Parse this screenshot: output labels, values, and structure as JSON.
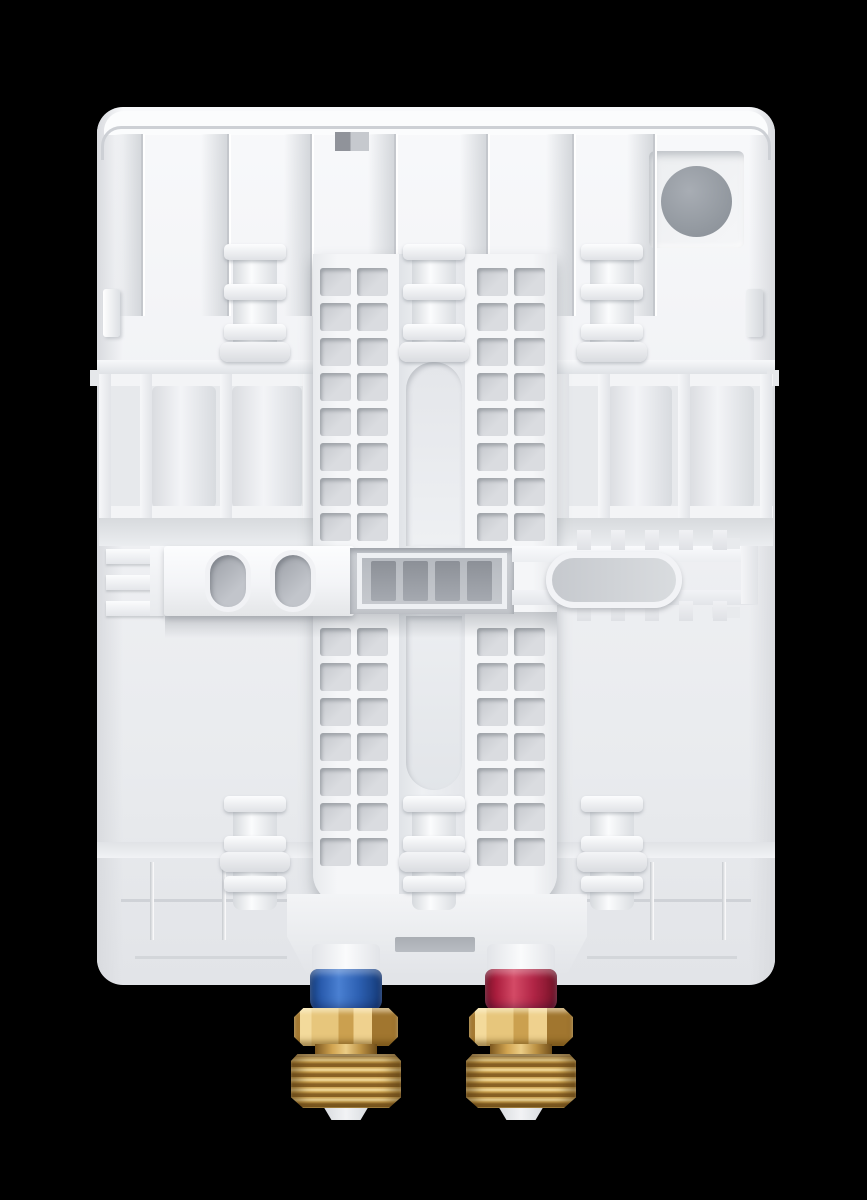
{
  "meta": {
    "description": "Product photo: rear mounting panel of a white tankless electric water heater on black background, with cold (blue) and hot (red) brass water connections at the bottom",
    "background_color": "#000000"
  },
  "device": {
    "type": "tankless-water-heater-back-panel",
    "body_color": "#f1f2f5",
    "recess_color": "#c9ccd1",
    "slot_color": "#a9adb3",
    "knockout_color": "#949aa1"
  },
  "connections": {
    "cold_inlet": {
      "name": "cold-water-inlet",
      "collar_color": "#2a5cae",
      "collar_gradient": "linear-gradient(90deg,#16407f 0%,#2a5cae 16%,#4a80d2 40%,#2d60b2 68%,#143a78 100%)"
    },
    "hot_outlet": {
      "name": "hot-water-outlet",
      "collar_color": "#ab1e3e",
      "collar_gradient": "linear-gradient(90deg,#7e142a 0%,#ab1e3e 16%,#d44a66 40%,#b02445 68%,#731226 100%)"
    },
    "brass_light": "#f3da9b",
    "brass_mid": "#cba04f",
    "brass_dark": "#8a6225"
  },
  "geometry": {
    "body": {
      "x": 97,
      "y": 107,
      "w": 678,
      "h": 878,
      "r": 26
    },
    "ribs": {
      "xs": [
        141,
        227,
        310,
        394,
        486,
        572,
        653
      ],
      "y": 134,
      "w": 4,
      "h": 182
    },
    "ladder": {
      "cols": [
        320,
        357,
        477,
        514
      ],
      "hole_w": 31,
      "hole_h": 28,
      "upper_rows": [
        268,
        303,
        338,
        373,
        408,
        443,
        478,
        513
      ],
      "lower_rows": [
        628,
        663,
        698,
        733,
        768,
        803,
        838
      ],
      "hole_fill": "linear-gradient(135deg,#c3c6cb,#dadce0 60%)",
      "hole_shadow": "inset 2px 3px 3px rgba(120,125,132,.5)"
    },
    "bosses": {
      "centers": [
        255,
        434,
        612
      ],
      "top_y": 244,
      "bottom_y": 796,
      "cyl_fill": "linear-gradient(90deg,#d6d9dd,#fbfcfd 42%,#dadde1)",
      "ring_fill": "linear-gradient(180deg,#fcfdfe,#e0e2e6)",
      "disc_fill": "linear-gradient(180deg,#f4f5f7,#dadce0)",
      "ring_shadow": "0 2px 3px rgba(140,146,153,.5)"
    },
    "teeth": {
      "xs": [
        577,
        611,
        645,
        679,
        713
      ],
      "y_top": 530,
      "y_bottom": 601,
      "w": 14,
      "h": 20,
      "fill": "linear-gradient(180deg,#f0f1f4,#dfe1e5)"
    },
    "fittings": [
      {
        "name": "cold-inlet",
        "cx": 346,
        "collar": "cold_inlet"
      },
      {
        "name": "hot-outlet",
        "cx": 521,
        "collar": "hot_outlet"
      }
    ],
    "fitting_style": {
      "stub_fill": "linear-gradient(90deg,#e2e4e8,#fafbfc 50%,#e2e4e8)",
      "hex_fill": "linear-gradient(90deg,#a87c33 0 6%,#f3da9b 6% 17%,#e7c67c 17% 43%,#cba04f 43% 57%,#efd18e 57% 75%,#a1762f 75% 100%)",
      "hex_clip": "polygon(9% 0,91% 0,100% 24%,100% 76%,91% 100%,9% 100%,0 76%,0 24%)",
      "hex_shadow": "inset 0 4px 4px rgba(255,248,220,.55), inset 0 -5px 6px rgba(90,60,10,.5)",
      "washer_fill": "linear-gradient(90deg,#7c571f,#d2a551 28%,#eccd86 50%,#bd9244 74%,#6f4d19)",
      "threads_fill": "repeating-linear-gradient(180deg,#8a6225 0px,#8a6225 3px,#caa04e 3px,#f4dda0 6px,#caa04e 8px,#8a6225 10px)",
      "threads_clip": "polygon(6% 0,94% 0,100% 13%,100% 80%,89% 100%,11% 100%,0 80%,0 13%)",
      "threads_shadow": "inset 10px 0 12px rgba(90,62,20,.55), inset -10px 0 12px rgba(90,62,20,.55), inset 0 3px 2px rgba(255,240,200,.6)",
      "tip_fill": "linear-gradient(90deg,#d4d7db,#f2f3f5 50%,#d4d7db)",
      "tip_clip": "polygon(6% 0,94% 0,78% 100%,22% 100%)",
      "collar_shadow": "inset 0 5px 6px rgba(255,255,255,.3), inset 0 -6px 9px rgba(10,10,40,.35)"
    },
    "parts": [
      {
        "n": "heater-body",
        "x": 97,
        "y": 107,
        "w": 678,
        "h": 878,
        "r": "26px",
        "f": "linear-gradient(180deg,#f8f9fb,#f1f2f5 35%,#e9ebee 75%,#e2e4e8 100%)",
        "z": 1
      },
      {
        "n": "body-left-shade",
        "x": 97,
        "y": 107,
        "w": 26,
        "h": 878,
        "r": "26px 0 0 26px",
        "f": "linear-gradient(90deg,#d9dbdf,rgba(217,219,223,0))",
        "z": 2
      },
      {
        "n": "body-right-shade",
        "x": 749,
        "y": 107,
        "w": 26,
        "h": 878,
        "r": "0 26px 26px 0",
        "f": "linear-gradient(270deg,#d9dbdf,rgba(217,219,223,0))",
        "z": 2
      },
      {
        "n": "top-cover-strip",
        "x": 104,
        "y": 111,
        "w": 664,
        "h": 24,
        "r": "20px 20px 0 0",
        "f": "#fbfcfd",
        "z": 2
      },
      {
        "n": "top-edge-line",
        "x": 101,
        "y": 126,
        "w": 670,
        "h": 34,
        "r": "20px 20px 0 0",
        "br": "3px solid #cdd0d5",
        "f": "transparent",
        "z": 3
      },
      {
        "n": "top-notch",
        "x": 335,
        "y": 132,
        "w": 34,
        "h": 19,
        "f": "linear-gradient(90deg,#90939a 0 45%,#c6c9ce 45%)",
        "z": 4
      },
      {
        "n": "cable-knockout-recess",
        "x": 649,
        "y": 151,
        "w": 95,
        "h": 97,
        "r": "6px",
        "f": "linear-gradient(135deg,#eceef0,#f5f6f8)",
        "s": "inset 3px 4px 8px rgba(140,146,153,.5), inset -2px -3px 5px rgba(255,255,255,.9)",
        "z": 4
      },
      {
        "n": "cable-knockout-circle",
        "x": 661,
        "y": 166,
        "w": 71,
        "h": 71,
        "r": "50%",
        "f": "radial-gradient(circle at 40% 35%, #a8adb4 0%, #949aa1 60%, #878d95 100%)",
        "z": 5
      },
      {
        "n": "side-tab-left",
        "x": 103,
        "y": 289,
        "w": 17,
        "h": 48,
        "r": "3px",
        "f": "linear-gradient(90deg,#ffffff,#dde0e4)",
        "s": "2px 2px 3px rgba(150,155,162,.4)",
        "z": 4
      },
      {
        "n": "side-tab-right",
        "x": 746,
        "y": 289,
        "w": 17,
        "h": 48,
        "r": "3px",
        "f": "linear-gradient(90deg,#eef0f2,#d6d9dd)",
        "s": "2px 2px 3px rgba(150,155,162,.4)",
        "z": 4
      },
      {
        "n": "side-stub-left",
        "x": 90,
        "y": 370,
        "w": 10,
        "h": 16,
        "f": "#e6e8eb",
        "z": 4
      },
      {
        "n": "side-stub-right",
        "x": 767,
        "y": 370,
        "w": 12,
        "h": 16,
        "f": "#e6e8eb",
        "z": 4
      },
      {
        "n": "ledge-left",
        "x": 97,
        "y": 360,
        "w": 218,
        "h": 14,
        "f": "linear-gradient(180deg,#f7f8fa,#dfe2e6)",
        "z": 3
      },
      {
        "n": "ledge-right",
        "x": 555,
        "y": 360,
        "w": 220,
        "h": 14,
        "f": "linear-gradient(180deg,#f7f8fa,#dfe2e6)",
        "z": 3
      },
      {
        "n": "left-frame-recess",
        "x": 99,
        "y": 374,
        "w": 216,
        "h": 146,
        "f": "#e7e9ec",
        "s": "inset 2px 3px 6px rgba(150,156,163,.45)",
        "z": 3
      },
      {
        "n": "left-frame-cylinder-1",
        "x": 152,
        "y": 386,
        "w": 64,
        "h": 122,
        "r": "6px",
        "f": "linear-gradient(90deg,#dadce0,#f3f4f7 45%,#d8dbdf)",
        "z": 3
      },
      {
        "n": "left-frame-cylinder-2",
        "x": 232,
        "y": 386,
        "w": 70,
        "h": 122,
        "r": "6px",
        "f": "linear-gradient(90deg,#dadce0,#f3f4f7 45%,#d8dbdf)",
        "z": 3
      },
      {
        "n": "left-frame-rail-top",
        "x": 99,
        "y": 374,
        "w": 216,
        "h": 12,
        "f": "#f3f4f6",
        "z": 4
      },
      {
        "n": "left-frame-rail-bottom",
        "x": 99,
        "y": 506,
        "w": 216,
        "h": 12,
        "f": "#f3f4f6",
        "z": 4
      },
      {
        "n": "left-frame-rail-v1",
        "x": 99,
        "y": 374,
        "w": 12,
        "h": 144,
        "f": "linear-gradient(90deg,#f6f7f9,#e2e4e8)",
        "z": 4
      },
      {
        "n": "left-frame-rail-v2",
        "x": 140,
        "y": 374,
        "w": 12,
        "h": 144,
        "f": "linear-gradient(90deg,#f6f7f9,#e2e4e8)",
        "z": 4
      },
      {
        "n": "left-frame-rail-v3",
        "x": 220,
        "y": 374,
        "w": 12,
        "h": 144,
        "f": "linear-gradient(90deg,#f6f7f9,#e2e4e8)",
        "z": 4
      },
      {
        "n": "left-frame-rail-v4",
        "x": 303,
        "y": 374,
        "w": 12,
        "h": 144,
        "f": "linear-gradient(90deg,#f6f7f9,#e2e4e8)",
        "z": 4
      },
      {
        "n": "right-frame-recess",
        "x": 557,
        "y": 374,
        "w": 216,
        "h": 146,
        "f": "#e7e9ec",
        "s": "inset 2px 3px 6px rgba(150,156,163,.45)",
        "z": 3
      },
      {
        "n": "right-frame-cylinder-1",
        "x": 608,
        "y": 386,
        "w": 64,
        "h": 122,
        "r": "6px",
        "f": "linear-gradient(90deg,#dadce0,#f3f4f7 45%,#d8dbdf)",
        "z": 3
      },
      {
        "n": "right-frame-cylinder-2",
        "x": 688,
        "y": 386,
        "w": 66,
        "h": 122,
        "r": "6px",
        "f": "linear-gradient(90deg,#dadce0,#f3f4f7 45%,#d8dbdf)",
        "z": 3
      },
      {
        "n": "right-frame-rail-top",
        "x": 557,
        "y": 374,
        "w": 216,
        "h": 12,
        "f": "#f3f4f6",
        "z": 4
      },
      {
        "n": "right-frame-rail-bottom",
        "x": 557,
        "y": 506,
        "w": 216,
        "h": 12,
        "f": "#f3f4f6",
        "z": 4
      },
      {
        "n": "right-frame-rail-v1",
        "x": 557,
        "y": 374,
        "w": 12,
        "h": 144,
        "f": "linear-gradient(90deg,#f6f7f9,#e2e4e8)",
        "z": 4
      },
      {
        "n": "right-frame-rail-v2",
        "x": 598,
        "y": 374,
        "w": 12,
        "h": 144,
        "f": "linear-gradient(90deg,#f6f7f9,#e2e4e8)",
        "z": 4
      },
      {
        "n": "right-frame-rail-v3",
        "x": 678,
        "y": 374,
        "w": 12,
        "h": 144,
        "f": "linear-gradient(90deg,#f6f7f9,#e2e4e8)",
        "z": 4
      },
      {
        "n": "right-frame-rail-v4",
        "x": 760,
        "y": 374,
        "w": 12,
        "h": 144,
        "f": "linear-gradient(90deg,#f6f7f9,#e2e4e8)",
        "z": 4
      },
      {
        "n": "mid-lower-shade-left",
        "x": 99,
        "y": 518,
        "w": 216,
        "h": 28,
        "f": "linear-gradient(180deg,#d7dadd,#ebedf0)",
        "z": 3
      },
      {
        "n": "mid-lower-shade-right",
        "x": 557,
        "y": 518,
        "w": 216,
        "h": 28,
        "f": "linear-gradient(180deg,#d7dadd,#ebedf0)",
        "z": 3
      },
      {
        "n": "ladder-slab",
        "x": 313,
        "y": 254,
        "w": 244,
        "h": 650,
        "r": "0 0 30px 30px",
        "f": "linear-gradient(90deg,#e8eaed,#f5f6f8 10%,#f5f6f8 90%,#e6e8eb)",
        "s": "0 8px 14px rgba(120,126,133,.45)",
        "z": 5
      },
      {
        "n": "ladder-center-channel",
        "x": 399,
        "y": 254,
        "w": 66,
        "h": 650,
        "f": "linear-gradient(90deg,#e0e3e7,#eef0f3 35%,#e4e6ea)",
        "z": 6
      },
      {
        "n": "center-slot-upper",
        "x": 406,
        "y": 362,
        "w": 56,
        "h": 184,
        "r": "28px 28px 0 0",
        "f": "linear-gradient(180deg,#e4e6ea,#eef0f3)",
        "s": "inset 2px 3px 5px rgba(140,146,153,.4)",
        "z": 7
      },
      {
        "n": "center-slot-lower",
        "x": 406,
        "y": 616,
        "w": 56,
        "h": 174,
        "r": "0 0 28px 28px",
        "f": "linear-gradient(180deg,#eceef1,#e2e5e9)",
        "s": "inset 2px 3px 5px rgba(140,146,153,.4)",
        "z": 7
      },
      {
        "n": "band-shadow",
        "x": 165,
        "y": 612,
        "w": 392,
        "h": 26,
        "f": "linear-gradient(180deg,rgba(120,126,133,.38),rgba(120,126,133,0))",
        "z": 9
      },
      {
        "n": "left-comb-bar-1",
        "x": 106,
        "y": 549,
        "w": 58,
        "h": 15,
        "f": "linear-gradient(180deg,#fbfcfd,#e4e6ea)",
        "s": "0 2px 2px rgba(140,146,153,.35)",
        "z": 10
      },
      {
        "n": "left-comb-bar-2",
        "x": 106,
        "y": 575,
        "w": 58,
        "h": 15,
        "f": "linear-gradient(180deg,#fbfcfd,#e4e6ea)",
        "s": "0 2px 2px rgba(140,146,153,.35)",
        "z": 10
      },
      {
        "n": "left-comb-bar-3",
        "x": 106,
        "y": 601,
        "w": 58,
        "h": 15,
        "f": "linear-gradient(180deg,#fbfcfd,#e4e6ea)",
        "s": "0 2px 2px rgba(140,146,153,.35)",
        "z": 10
      },
      {
        "n": "left-comb-spine",
        "x": 150,
        "y": 546,
        "w": 16,
        "h": 70,
        "f": "linear-gradient(180deg,#f8f9fb,#e8eaed)",
        "z": 10
      },
      {
        "n": "mounting-band-left",
        "x": 164,
        "y": 546,
        "w": 190,
        "h": 70,
        "r": "3px",
        "f": "linear-gradient(180deg,#fcfdfe,#f3f4f7 55%,#e4e6e8)",
        "s": "0 3px 6px rgba(120,126,133,.4)",
        "z": 10
      },
      {
        "n": "mounting-slot-oval-1",
        "x": 205,
        "y": 550,
        "w": 46,
        "h": 62,
        "r": "23px",
        "f": "linear-gradient(135deg,#9b9fa6,#c2c5cb 70%)",
        "br": "5px solid #f1f2f5",
        "s": "inset 2px 3px 4px rgba(70,75,82,.35)",
        "z": 11
      },
      {
        "n": "mounting-slot-oval-2",
        "x": 270,
        "y": 550,
        "w": 46,
        "h": 62,
        "r": "23px",
        "f": "linear-gradient(135deg,#9b9fa6,#c2c5cb 70%)",
        "br": "5px solid #f1f2f5",
        "s": "inset 2px 3px 4px rgba(70,75,82,.35)",
        "z": 11
      },
      {
        "n": "center-plate-recess",
        "x": 350,
        "y": 548,
        "w": 164,
        "h": 66,
        "f": "linear-gradient(180deg,#cdd0d5,#c2c5ca)",
        "s": "inset 0 3px 6px rgba(100,106,113,.5)",
        "z": 10
      },
      {
        "n": "center-plate-frame",
        "x": 357,
        "y": 553,
        "w": 150,
        "h": 56,
        "br": "5px solid #eef0f3",
        "f": "linear-gradient(180deg,#b6bac0,#c6c9ce)",
        "z": 11
      },
      {
        "n": "center-plate-slot-1",
        "x": 371,
        "y": 561,
        "w": 25,
        "h": 40,
        "r": "2px",
        "f": "linear-gradient(180deg,#8c9097,#a5a9b0)",
        "z": 12
      },
      {
        "n": "center-plate-slot-2",
        "x": 403,
        "y": 561,
        "w": 25,
        "h": 40,
        "r": "2px",
        "f": "linear-gradient(180deg,#8c9097,#a5a9b0)",
        "z": 12
      },
      {
        "n": "center-plate-slot-3",
        "x": 435,
        "y": 561,
        "w": 25,
        "h": 40,
        "r": "2px",
        "f": "linear-gradient(180deg,#8c9097,#a5a9b0)",
        "z": 12
      },
      {
        "n": "center-plate-slot-4",
        "x": 467,
        "y": 561,
        "w": 25,
        "h": 40,
        "r": "2px",
        "f": "linear-gradient(180deg,#8c9097,#a5a9b0)",
        "z": 12
      },
      {
        "n": "right-band-rail-top",
        "x": 512,
        "y": 546,
        "w": 246,
        "h": 16,
        "f": "linear-gradient(180deg,#f9fafc,#eceef1)",
        "z": 10
      },
      {
        "n": "right-band-rail-bottom",
        "x": 512,
        "y": 590,
        "w": 246,
        "h": 15,
        "f": "linear-gradient(180deg,#f2f3f6,#e3e5e9)",
        "z": 10
      },
      {
        "n": "bracket-slot-stadium",
        "x": 546,
        "y": 552,
        "w": 136,
        "h": 56,
        "r": "28px",
        "f": "linear-gradient(90deg,#c6c9ce,#d9dcdf)",
        "br": "6px solid #f2f3f6",
        "s": "0 3px 5px rgba(120,126,133,.4)",
        "z": 11
      },
      {
        "n": "right-bracket-cap-top",
        "x": 712,
        "y": 538,
        "w": 28,
        "h": 11,
        "f": "#e8eaed",
        "z": 10
      },
      {
        "n": "right-bracket-cap-bottom",
        "x": 712,
        "y": 607,
        "w": 28,
        "h": 11,
        "f": "#e8eaed",
        "z": 10
      },
      {
        "n": "right-band-end",
        "x": 741,
        "y": 546,
        "w": 17,
        "h": 58,
        "f": "linear-gradient(90deg,#f4f5f7,#e0e2e6)",
        "z": 10
      },
      {
        "n": "bottom-ledge-left",
        "x": 97,
        "y": 842,
        "w": 218,
        "h": 16,
        "f": "linear-gradient(180deg,#e0e2e6,#f1f2f5)",
        "z": 4
      },
      {
        "n": "bottom-ledge-right",
        "x": 555,
        "y": 842,
        "w": 220,
        "h": 16,
        "f": "linear-gradient(180deg,#e0e2e6,#f1f2f5)",
        "z": 4
      },
      {
        "n": "skirt-line-left",
        "x": 121,
        "y": 899,
        "w": 166,
        "h": 3,
        "f": "#cfd2d7",
        "z": 4
      },
      {
        "n": "skirt-line-right",
        "x": 587,
        "y": 899,
        "w": 164,
        "h": 3,
        "f": "#cfd2d7",
        "z": 4
      },
      {
        "n": "skirt-rib-1",
        "x": 150,
        "y": 862,
        "w": 4,
        "h": 78,
        "f": "linear-gradient(90deg,#c6c9ce,#ffffff)",
        "z": 4
      },
      {
        "n": "skirt-rib-2",
        "x": 222,
        "y": 862,
        "w": 4,
        "h": 78,
        "f": "linear-gradient(90deg,#c6c9ce,#ffffff)",
        "z": 4
      },
      {
        "n": "skirt-rib-3",
        "x": 650,
        "y": 862,
        "w": 4,
        "h": 78,
        "f": "linear-gradient(90deg,#c6c9ce,#ffffff)",
        "z": 4
      },
      {
        "n": "skirt-rib-4",
        "x": 722,
        "y": 862,
        "w": 4,
        "h": 78,
        "f": "linear-gradient(90deg,#c6c9ce,#ffffff)",
        "z": 4
      },
      {
        "n": "inner-bottom-line-left",
        "x": 135,
        "y": 956,
        "w": 152,
        "h": 3,
        "f": "#d3d6da",
        "z": 4
      },
      {
        "n": "inner-bottom-line-right",
        "x": 587,
        "y": 956,
        "w": 150,
        "h": 3,
        "f": "#d3d6da",
        "z": 4
      },
      {
        "n": "bottom-center-protrusion",
        "x": 287,
        "y": 894,
        "w": 300,
        "h": 82,
        "c": "polygon(0 0,100% 0,100% 52%,93% 100%,7% 100%,0 52%)",
        "f": "linear-gradient(180deg,#f3f4f6,#e9ebee 60%,#e2e4e8)",
        "z": 6
      },
      {
        "n": "bottom-center-slot",
        "x": 395,
        "y": 937,
        "w": 80,
        "h": 15,
        "r": "2px",
        "f": "linear-gradient(180deg,#a9adb3,#b8bcc2)",
        "z": 7
      }
    ]
  }
}
